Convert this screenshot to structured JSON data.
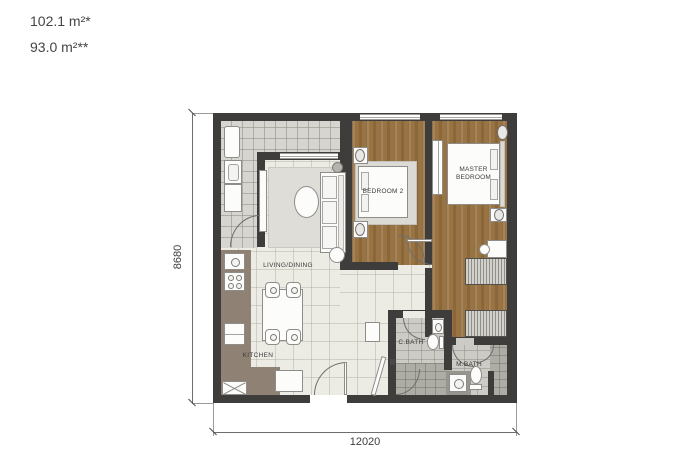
{
  "header": {
    "area_line1": "102.1 m²*",
    "area_line2": "93.0 m²**"
  },
  "dimensions": {
    "horizontal": "12020",
    "vertical": "8680"
  },
  "rooms": {
    "living_dining": "LIVING/DINING",
    "kitchen": "KITCHEN",
    "bedroom2": "BEDROOM 2",
    "master_bedroom": "MASTER BEDROOM",
    "c_bath": "C.BATH",
    "m_bath": "M.BATH"
  },
  "colors": {
    "wall": "#3e3d3b",
    "wood_floor": "#9a7342",
    "living_floor": "#edece4",
    "balcony_floor": "#d6d5cf",
    "bath_floor": "#cccbc5",
    "kitchen_counter": "#8f8275"
  }
}
